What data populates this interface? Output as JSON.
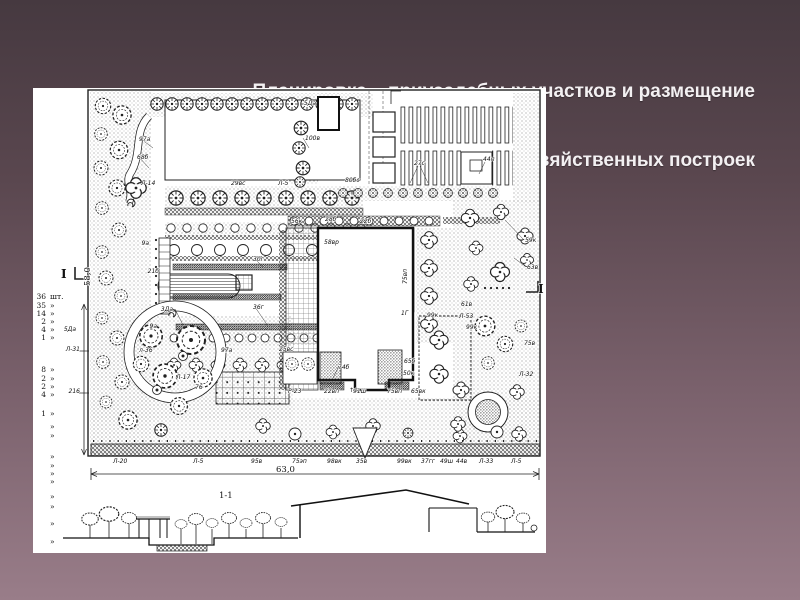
{
  "slide": {
    "title_line1": "Планировка    приусадебных участков и размещение",
    "title_line2": "хозяйственных построек"
  },
  "plan": {
    "section_title": "1-1",
    "dim_width": "63,0",
    "dim_height": "58,0",
    "legend": [
      {
        "n": "36",
        "u": "шт.",
        "y": 211
      },
      {
        "n": "35",
        "u": "»",
        "y": 220
      },
      {
        "n": "14",
        "u": "»",
        "y": 228
      },
      {
        "n": "2",
        "u": "»",
        "y": 236
      },
      {
        "n": "4",
        "u": "»",
        "y": 244
      },
      {
        "n": "1",
        "u": "»",
        "y": 252
      },
      {
        "n": "8",
        "u": "»",
        "y": 284
      },
      {
        "n": "2",
        "u": "»",
        "y": 293
      },
      {
        "n": "2",
        "u": "»",
        "y": 301
      },
      {
        "n": "4",
        "u": "»",
        "y": 309
      },
      {
        "n": "1",
        "u": "»",
        "y": 328
      },
      {
        "n": "",
        "u": "»",
        "y": 341
      },
      {
        "n": "",
        "u": "»",
        "y": 350
      },
      {
        "n": "",
        "u": "»",
        "y": 371
      },
      {
        "n": "",
        "u": "»",
        "y": 380
      },
      {
        "n": "",
        "u": "»",
        "y": 388
      },
      {
        "n": "",
        "u": "»",
        "y": 396
      },
      {
        "n": "",
        "u": "»",
        "y": 411
      },
      {
        "n": "",
        "u": "»",
        "y": 421
      },
      {
        "n": "",
        "u": "»",
        "y": 438
      },
      {
        "n": "",
        "u": "»",
        "y": 456
      }
    ],
    "labels": [
      {
        "t": "5Да",
        "x": 283,
        "y": 17,
        "a": "end"
      },
      {
        "t": "100в",
        "x": 272,
        "y": 52
      },
      {
        "t": "97а",
        "x": 106,
        "y": 53
      },
      {
        "t": "68б",
        "x": 104,
        "y": 71
      },
      {
        "t": "Л-14",
        "x": 108,
        "y": 97
      },
      {
        "t": "29вс",
        "x": 198,
        "y": 97
      },
      {
        "t": "Л-5",
        "x": 245,
        "y": 97
      },
      {
        "t": "80бс",
        "x": 312,
        "y": 94
      },
      {
        "t": "27с",
        "x": 381,
        "y": 77
      },
      {
        "t": "44п",
        "x": 450,
        "y": 73
      },
      {
        "t": "56к",
        "x": 258,
        "y": 135
      },
      {
        "t": "28б",
        "x": 292,
        "y": 133
      },
      {
        "t": "22б",
        "x": 327,
        "y": 135
      },
      {
        "t": "58вр",
        "x": 291,
        "y": 156
      },
      {
        "t": "75вп",
        "x": 374,
        "y": 196,
        "r": -90
      },
      {
        "t": "59к",
        "x": 492,
        "y": 154
      },
      {
        "t": "63в",
        "x": 494,
        "y": 181
      },
      {
        "t": "61в",
        "x": 428,
        "y": 218
      },
      {
        "t": "Л-53",
        "x": 426,
        "y": 230
      },
      {
        "t": "99к",
        "x": 433,
        "y": 241
      },
      {
        "t": "1Г",
        "x": 368,
        "y": 227
      },
      {
        "t": "99к",
        "x": 394,
        "y": 229
      },
      {
        "t": "75в",
        "x": 491,
        "y": 257
      },
      {
        "t": "Л-32",
        "x": 486,
        "y": 288
      },
      {
        "t": "65б",
        "x": 371,
        "y": 275
      },
      {
        "t": "50к",
        "x": 370,
        "y": 287
      },
      {
        "t": "74б",
        "x": 305,
        "y": 281
      },
      {
        "t": "↑↑",
        "x": 316,
        "y": 304
      },
      {
        "t": "9а",
        "x": 116,
        "y": 157,
        "a": "end"
      },
      {
        "t": "21б",
        "x": 126,
        "y": 185,
        "a": "end"
      },
      {
        "t": "30г",
        "x": 220,
        "y": 173
      },
      {
        "t": "36г",
        "x": 220,
        "y": 221
      },
      {
        "t": "3Да",
        "x": 140,
        "y": 223,
        "a": "end"
      },
      {
        "t": "9а",
        "x": 124,
        "y": 240,
        "a": "end"
      },
      {
        "t": "97а",
        "x": 188,
        "y": 264
      },
      {
        "t": "25вс",
        "x": 246,
        "y": 263
      },
      {
        "t": "л-36",
        "x": 106,
        "y": 264
      },
      {
        "t": "Л-17",
        "x": 143,
        "y": 291
      },
      {
        "t": "76",
        "x": 162,
        "y": 301
      },
      {
        "t": "Р-23",
        "x": 255,
        "y": 305
      },
      {
        "t": "22вп",
        "x": 291,
        "y": 305
      },
      {
        "t": "91ш",
        "x": 320,
        "y": 305
      },
      {
        "t": "75вп",
        "x": 354,
        "y": 305
      },
      {
        "t": "65вк",
        "x": 378,
        "y": 305
      },
      {
        "t": "Л-20",
        "x": 80,
        "y": 375
      },
      {
        "t": "Л-5",
        "x": 160,
        "y": 375
      },
      {
        "t": "95в",
        "x": 218,
        "y": 375
      },
      {
        "t": "75эп",
        "x": 259,
        "y": 375
      },
      {
        "t": "98вк",
        "x": 294,
        "y": 375
      },
      {
        "t": "35в",
        "x": 323,
        "y": 375
      },
      {
        "t": "99вк",
        "x": 364,
        "y": 375
      },
      {
        "t": "37гг",
        "x": 388,
        "y": 375
      },
      {
        "t": "49ш",
        "x": 407,
        "y": 375
      },
      {
        "t": "44в",
        "x": 423,
        "y": 375
      },
      {
        "t": "Л-33",
        "x": 446,
        "y": 375
      },
      {
        "t": "Л-5",
        "x": 478,
        "y": 375
      },
      {
        "t": "63,0",
        "x": 243,
        "y": 384,
        "c": "mid"
      },
      {
        "t": "58,0",
        "x": 57,
        "y": 198,
        "r": -90,
        "c": "mid"
      },
      {
        "t": "216",
        "x": 47,
        "y": 305,
        "a": "end"
      },
      {
        "t": "Л-31",
        "x": 47,
        "y": 263,
        "a": "end"
      },
      {
        "t": "5Да",
        "x": 43,
        "y": 243,
        "a": "end"
      },
      {
        "t": "1-1",
        "x": 186,
        "y": 410,
        "c": "mid"
      },
      {
        "t": "I",
        "x": 28,
        "y": 190,
        "c": "big"
      },
      {
        "t": "I",
        "x": 505,
        "y": 205,
        "c": "big"
      }
    ]
  }
}
